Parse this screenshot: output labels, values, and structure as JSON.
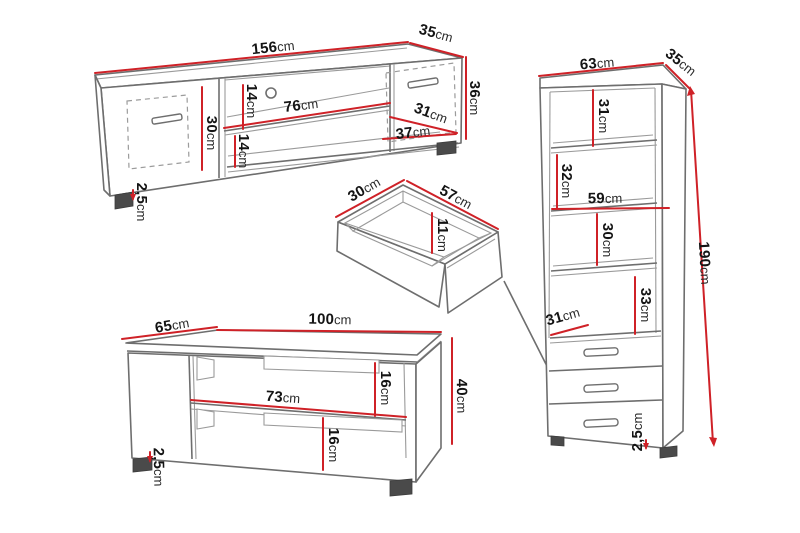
{
  "colors": {
    "dimension_red": "#cf2127",
    "outline_gray": "#6e6e6e",
    "light_gray": "#9a9a9a",
    "text_black": "#141414",
    "background": "#ffffff"
  },
  "tv_stand": {
    "width": {
      "value": "156",
      "unit": "cm"
    },
    "depth": {
      "value": "35",
      "unit": "cm"
    },
    "height": {
      "value": "36",
      "unit": "cm"
    },
    "left_door_height": {
      "value": "30",
      "unit": "cm"
    },
    "upper_shelf_gap": {
      "value": "14",
      "unit": "cm"
    },
    "shelf_width": {
      "value": "76",
      "unit": "cm"
    },
    "lower_shelf_gap": {
      "value": "14",
      "unit": "cm"
    },
    "right_door_width": {
      "value": "31",
      "unit": "cm"
    },
    "right_section_width": {
      "value": "37",
      "unit": "cm"
    },
    "plinth_height": {
      "value": "2,5",
      "unit": "cm"
    }
  },
  "drawer": {
    "depth": {
      "value": "30",
      "unit": "cm"
    },
    "width": {
      "value": "57",
      "unit": "cm"
    },
    "inner_height": {
      "value": "11",
      "unit": "cm"
    }
  },
  "coffee_table": {
    "depth": {
      "value": "65",
      "unit": "cm"
    },
    "width": {
      "value": "100",
      "unit": "cm"
    },
    "height": {
      "value": "40",
      "unit": "cm"
    },
    "upper_gap": {
      "value": "16",
      "unit": "cm"
    },
    "shelf_width": {
      "value": "73",
      "unit": "cm"
    },
    "lower_gap": {
      "value": "16",
      "unit": "cm"
    },
    "plinth_height": {
      "value": "2,5",
      "unit": "cm"
    }
  },
  "cabinet": {
    "width": {
      "value": "63",
      "unit": "cm"
    },
    "depth": {
      "value": "35",
      "unit": "cm"
    },
    "section_1_height": {
      "value": "31",
      "unit": "cm"
    },
    "section_2_height": {
      "value": "32",
      "unit": "cm"
    },
    "shelf_width": {
      "value": "59",
      "unit": "cm"
    },
    "section_3_height": {
      "value": "30",
      "unit": "cm"
    },
    "section_4_height": {
      "value": "33",
      "unit": "cm"
    },
    "drawer_section_depth": {
      "value": "31",
      "unit": "cm"
    },
    "height": {
      "value": "190",
      "unit": "cm"
    },
    "plinth_height": {
      "value": "2,5",
      "unit": "cm"
    }
  }
}
